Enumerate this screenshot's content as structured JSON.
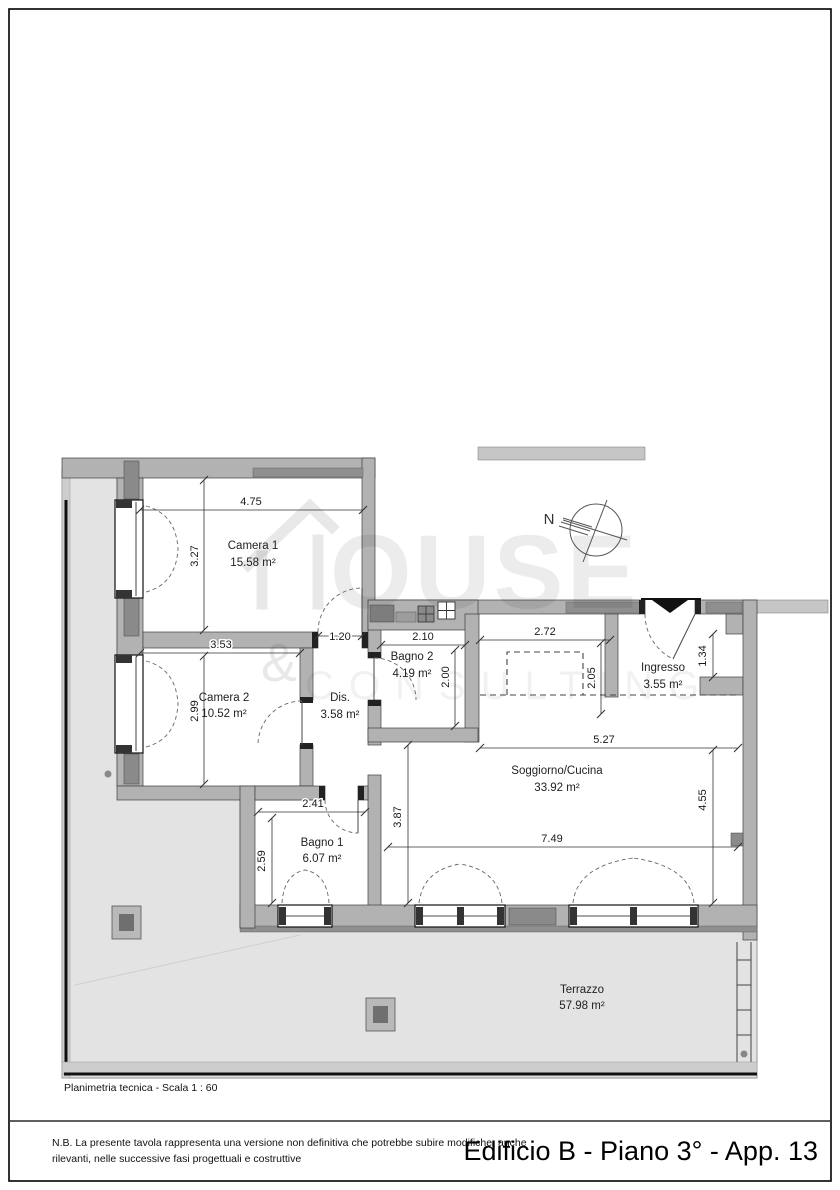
{
  "page": {
    "scale_note": "Planimetria tecnica - Scala 1 : 60",
    "footer": {
      "disclaimer_line1": "N.B. La presente tavola rappresenta una versione non definitiva che potrebbe subire modifiche, anche",
      "disclaimer_line2": "rilevanti, nelle successive fasi progettuali e costruttive",
      "title": "Edificio B - Piano 3° - App. 13"
    }
  },
  "compass": {
    "north_label": "N"
  },
  "watermark": {
    "word_tail": "OUSE",
    "ampersand": "&",
    "word_sub": "CONSULTING"
  },
  "rooms": [
    {
      "name": "Camera 1",
      "area": "15.58 m²"
    },
    {
      "name": "Camera 2",
      "area": "10.52 m²"
    },
    {
      "name": "Dis.",
      "area": "3.58 m²"
    },
    {
      "name": "Bagno 2",
      "area": "4.19 m²"
    },
    {
      "name": "Bagno 1",
      "area": "6.07 m²"
    },
    {
      "name": "Soggiorno/Cucina",
      "area": "33.92 m²"
    },
    {
      "name": "Ingresso",
      "area": "3.55 m²"
    },
    {
      "name": "Terrazzo",
      "area": "57.98 m²"
    }
  ],
  "dimensions": {
    "camera1_width": "4.75",
    "camera1_height": "3.27",
    "camera2_width": "3.53",
    "camera2_height": "2.99",
    "passage_width": "1.20",
    "bagno2_width": "2.10",
    "bagno2_height": "2.00",
    "corridor_width": "2.72",
    "corridor_height": "2.05",
    "ingresso_niche": "1.34",
    "soggiorno_top_width": "5.27",
    "soggiorno_right_height": "4.55",
    "soggiorno_bottom_width": "7.49",
    "soggiorno_left_height": "3.87",
    "bagno1_width": "2.41",
    "bagno1_height": "2.59"
  }
}
